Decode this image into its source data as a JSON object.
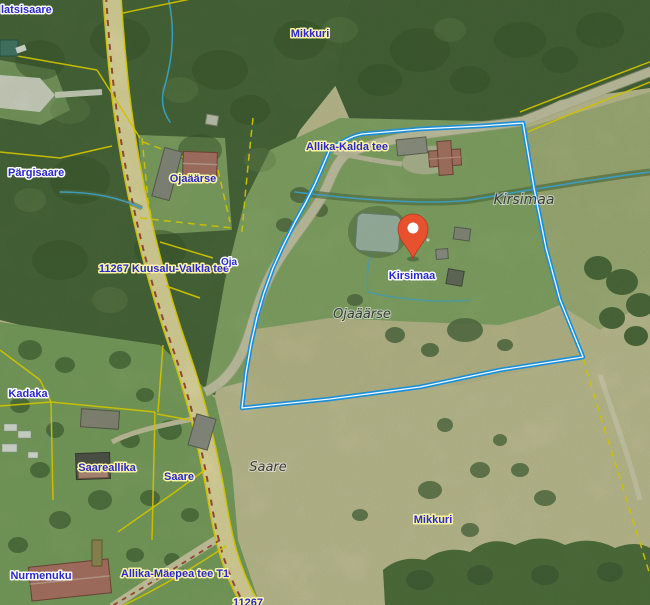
{
  "colors": {
    "selected_parcel": "#1a8fd8",
    "cadastral_line": "#f0d800",
    "marker": "#e8512e",
    "marker_dark": "#b23a1e",
    "label_blue": "#2828cc",
    "halo_yellow": "#fdf5a6",
    "halo_white": "#ffffff",
    "cadastral_text": "#3b3b3b",
    "stream": "#45aede",
    "road_fill": "#e9dba4",
    "road_edge_red": "#a84a38",
    "gravel_fill": "#cfc7ad",
    "forest": "#4d653e",
    "grass": "#8aa76c",
    "field_tan": "#c9c19a",
    "field_olive": "#a9b17e"
  },
  "marker": {
    "label": "Kirsimaa"
  },
  "labels": {
    "latsisaare": "latsisaare",
    "mikkuri_top": "Mikkuri",
    "pargisaare": "Pärgisaare",
    "ojaaarse_top": "Ojaäärse",
    "allika_kalda_tee": "Allika-Kalda tee",
    "kirsimaa_name": "Kirsimaa",
    "kuusalu_valkla_tee": "11267 Kuusalu-Valkla tee",
    "oja": "Oja",
    "kirsimaa_marker": "Kirsimaa",
    "ojaaarse_name": "Ojaäärse",
    "kadaka": "Kadaka",
    "saareallika": "Saareallika",
    "saare_place": "Saare",
    "saare_name": "Saare",
    "mikkuri_bottom": "Mikkuri",
    "nurmenuku": "Nurmenuku",
    "allika_maepea_tee": "Allika-Mäepea tee T1",
    "road_number_bottom": "11267"
  }
}
